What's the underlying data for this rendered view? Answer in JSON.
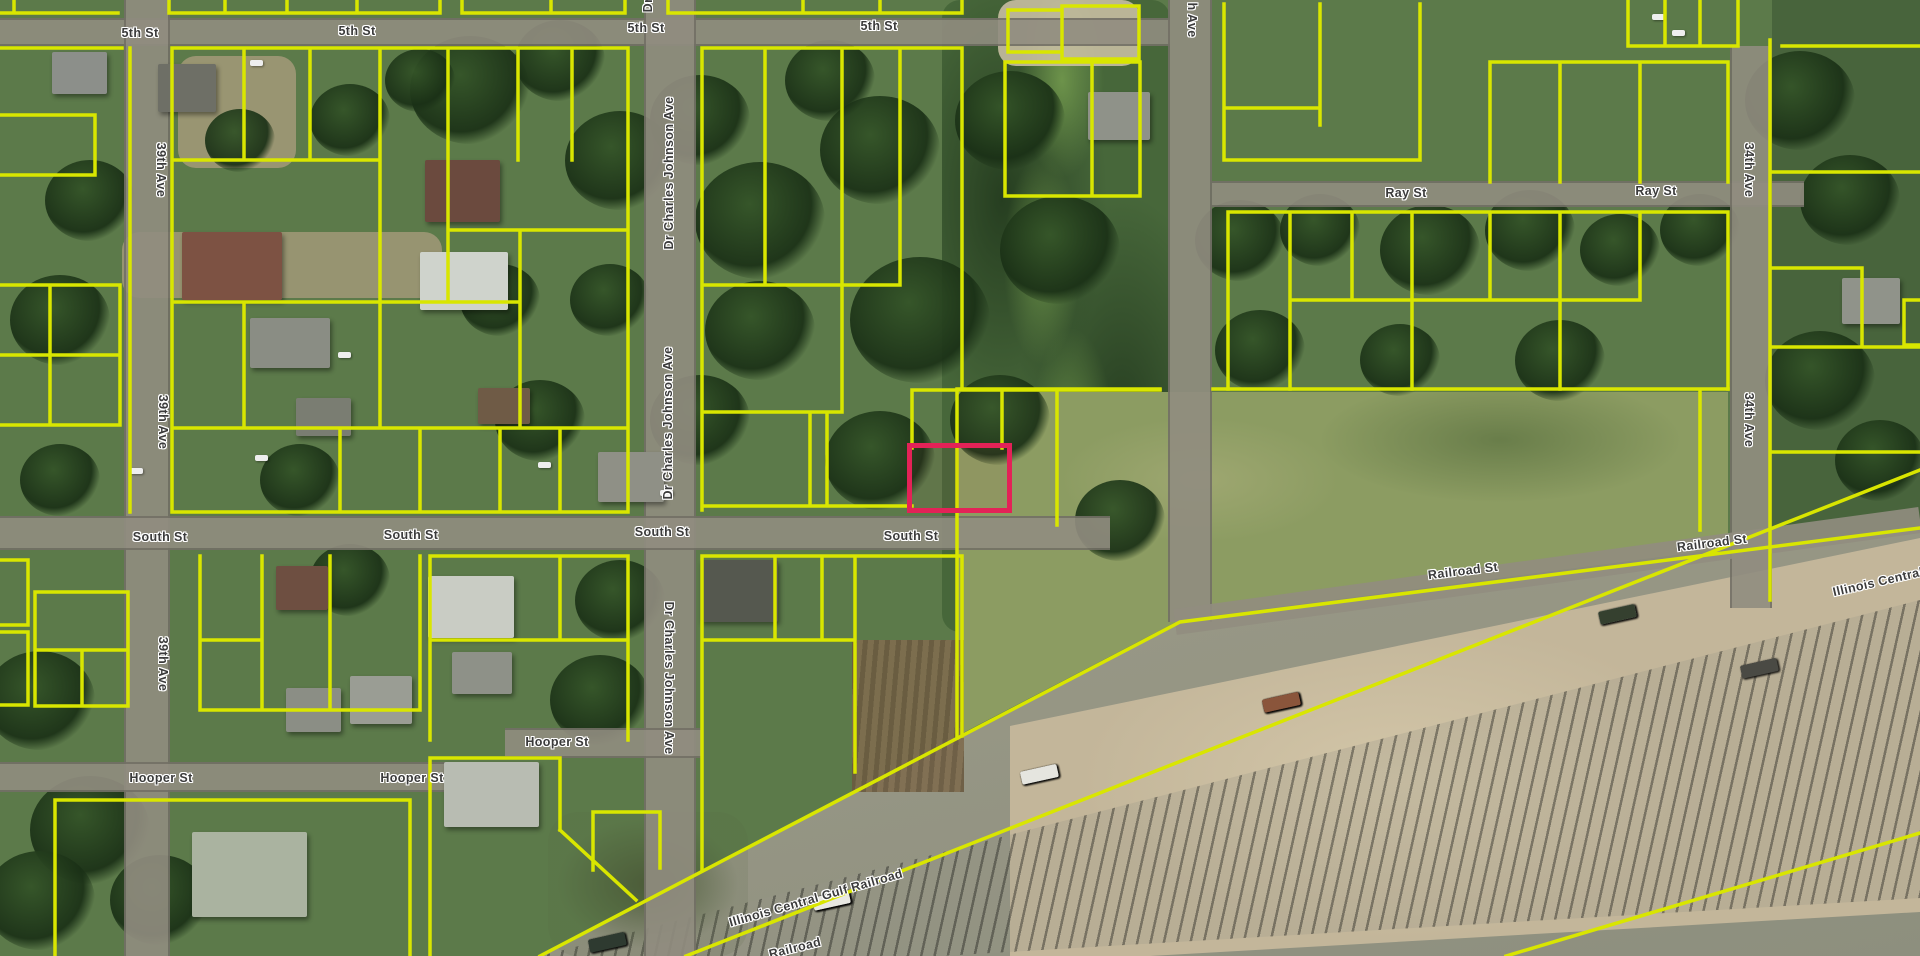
{
  "map": {
    "description": "Aerial parcel map with highlighted parcel",
    "parcel_line_color": "#d9e600",
    "highlight_color": "#e32257",
    "label_color": "#3b3b3b",
    "label_halo_color": "#ffffff"
  },
  "selected_parcel": {
    "x": 912,
    "y": 448,
    "width": 95,
    "height": 60
  },
  "street_labels": [
    {
      "text": "5th St",
      "x": 140,
      "y": 33,
      "rot": 0
    },
    {
      "text": "5th St",
      "x": 357,
      "y": 31,
      "rot": 0
    },
    {
      "text": "5th St",
      "x": 646,
      "y": 28,
      "rot": 0
    },
    {
      "text": "5th St",
      "x": 879,
      "y": 26,
      "rot": 0
    },
    {
      "text": "Dr",
      "x": 648,
      "y": 5,
      "rot": -90
    },
    {
      "text": "39th Ave",
      "x": 161,
      "y": 170,
      "rot": 90
    },
    {
      "text": "39th Ave",
      "x": 163,
      "y": 422,
      "rot": 90
    },
    {
      "text": "39th Ave",
      "x": 163,
      "y": 664,
      "rot": 90
    },
    {
      "text": "Dr Charles Johnson Ave",
      "x": 669,
      "y": 173,
      "rot": -90
    },
    {
      "text": "Dr Charles Johnson Ave",
      "x": 668,
      "y": 423,
      "rot": -90
    },
    {
      "text": "Dr Charles Johnson Ave",
      "x": 669,
      "y": 678,
      "rot": 90
    },
    {
      "text": "h Ave",
      "x": 1192,
      "y": 20,
      "rot": 90
    },
    {
      "text": "Ray St",
      "x": 1406,
      "y": 193,
      "rot": 0
    },
    {
      "text": "Ray St",
      "x": 1656,
      "y": 191,
      "rot": 0
    },
    {
      "text": "34th Ave",
      "x": 1749,
      "y": 170,
      "rot": 90
    },
    {
      "text": "34th Ave",
      "x": 1749,
      "y": 420,
      "rot": 90
    },
    {
      "text": "South St",
      "x": 160,
      "y": 537,
      "rot": 0
    },
    {
      "text": "South St",
      "x": 411,
      "y": 535,
      "rot": 0
    },
    {
      "text": "South St",
      "x": 662,
      "y": 532,
      "rot": 0
    },
    {
      "text": "South St",
      "x": 911,
      "y": 536,
      "rot": 0
    },
    {
      "text": "Railroad St",
      "x": 1463,
      "y": 571,
      "rot": -7
    },
    {
      "text": "Railroad St",
      "x": 1712,
      "y": 543,
      "rot": -7
    },
    {
      "text": "Hooper St",
      "x": 161,
      "y": 778,
      "rot": 0
    },
    {
      "text": "Hooper St",
      "x": 412,
      "y": 778,
      "rot": 0
    },
    {
      "text": "Hooper St",
      "x": 557,
      "y": 742,
      "rot": 0
    },
    {
      "text": "Illinois Central Gulf Railroad",
      "x": 816,
      "y": 898,
      "rot": -16
    },
    {
      "text": "Railroad",
      "x": 795,
      "y": 948,
      "rot": -14
    },
    {
      "text": "Illinois Central",
      "x": 1878,
      "y": 582,
      "rot": -13
    }
  ]
}
